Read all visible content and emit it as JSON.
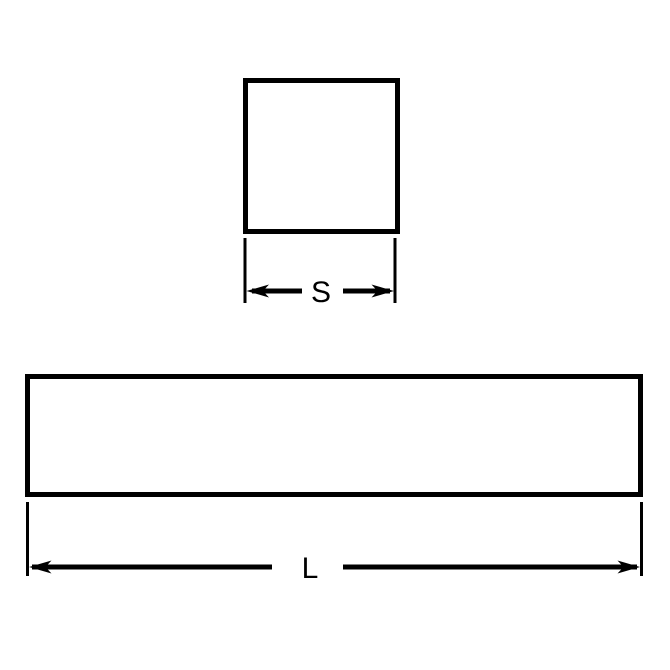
{
  "colors": {
    "line": "#000000",
    "background": "#ffffff"
  },
  "dimensions": {
    "square_width_label": "S",
    "bar_length_label": "L"
  }
}
